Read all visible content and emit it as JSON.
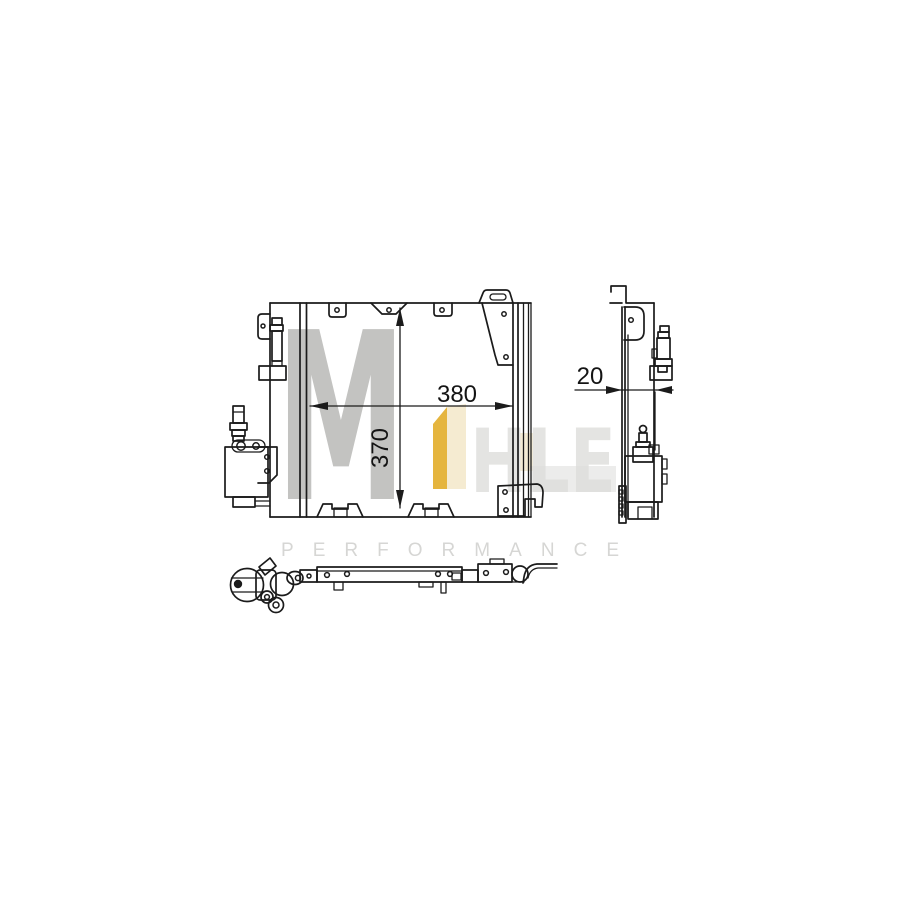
{
  "canvas": {
    "width": 900,
    "height": 900,
    "background": "#ffffff"
  },
  "drawing": {
    "front_view": {
      "width_dim_label": "380",
      "height_dim_label": "370"
    },
    "side_view": {
      "depth_dim_label": "20"
    }
  },
  "watermark": {
    "big_letter": "M",
    "faint_letters": "HLE",
    "subtitle": "PERFORMANCE",
    "accent_color": "#e5b53e",
    "accent_light": "#f5ebd1",
    "gray_color": "#c3c3c1",
    "faint_gray": "#e4e4e2",
    "subtitle_gray": "#d6d6d4"
  }
}
